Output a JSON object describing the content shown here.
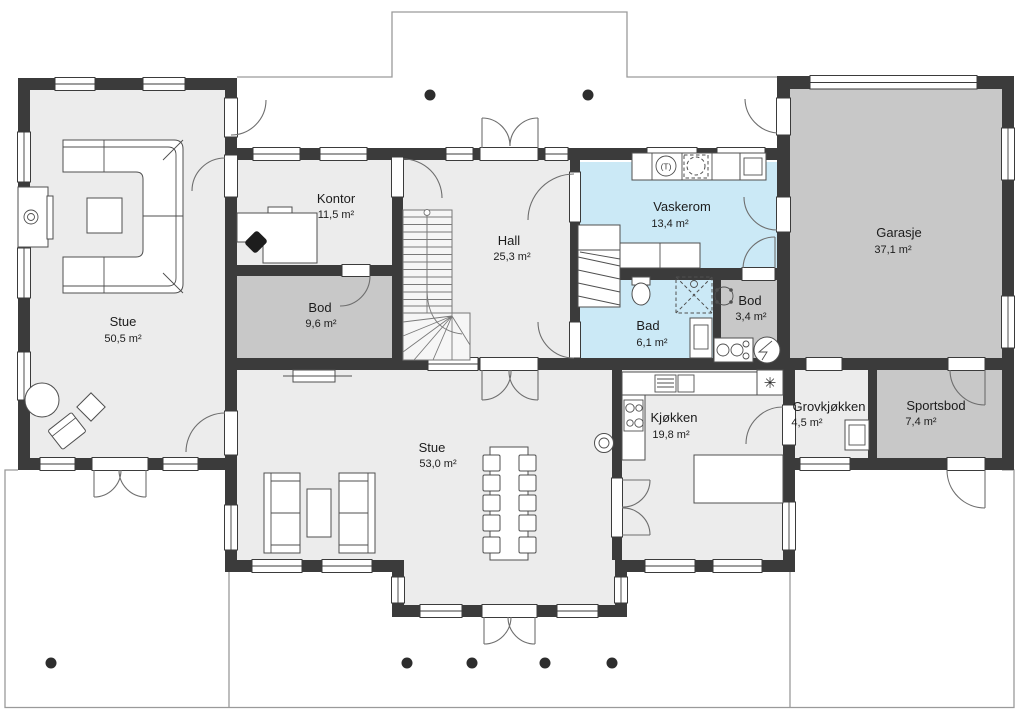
{
  "colors": {
    "wall": "#3b3b3b",
    "floor": "#ececec",
    "storage": "#c8c8c8",
    "wet": "#cbe9f6",
    "outline": "#9a9a9a"
  },
  "symbols": {
    "dryer": "(T)",
    "vent": "✳"
  },
  "rooms": [
    {
      "id": "stue-upper",
      "name": "Stue",
      "area": "50,5 m²"
    },
    {
      "id": "kontor",
      "name": "Kontor",
      "area": "11,5 m²"
    },
    {
      "id": "bod-1",
      "name": "Bod",
      "area": "9,6 m²"
    },
    {
      "id": "hall",
      "name": "Hall",
      "area": "25,3 m²"
    },
    {
      "id": "vaskerom",
      "name": "Vaskerom",
      "area": "13,4 m²"
    },
    {
      "id": "bad",
      "name": "Bad",
      "area": "6,1 m²"
    },
    {
      "id": "bod-2",
      "name": "Bod",
      "area": "3,4 m²"
    },
    {
      "id": "garasje",
      "name": "Garasje",
      "area": "37,1 m²"
    },
    {
      "id": "sportsbod",
      "name": "Sportsbod",
      "area": "7,4 m²"
    },
    {
      "id": "grovkjokken",
      "name": "Grovkjøkken",
      "area": "4,5 m²"
    },
    {
      "id": "kjokken",
      "name": "Kjøkken",
      "area": "19,8 m²"
    },
    {
      "id": "stue-lower",
      "name": "Stue",
      "area": "53,0 m²"
    }
  ]
}
